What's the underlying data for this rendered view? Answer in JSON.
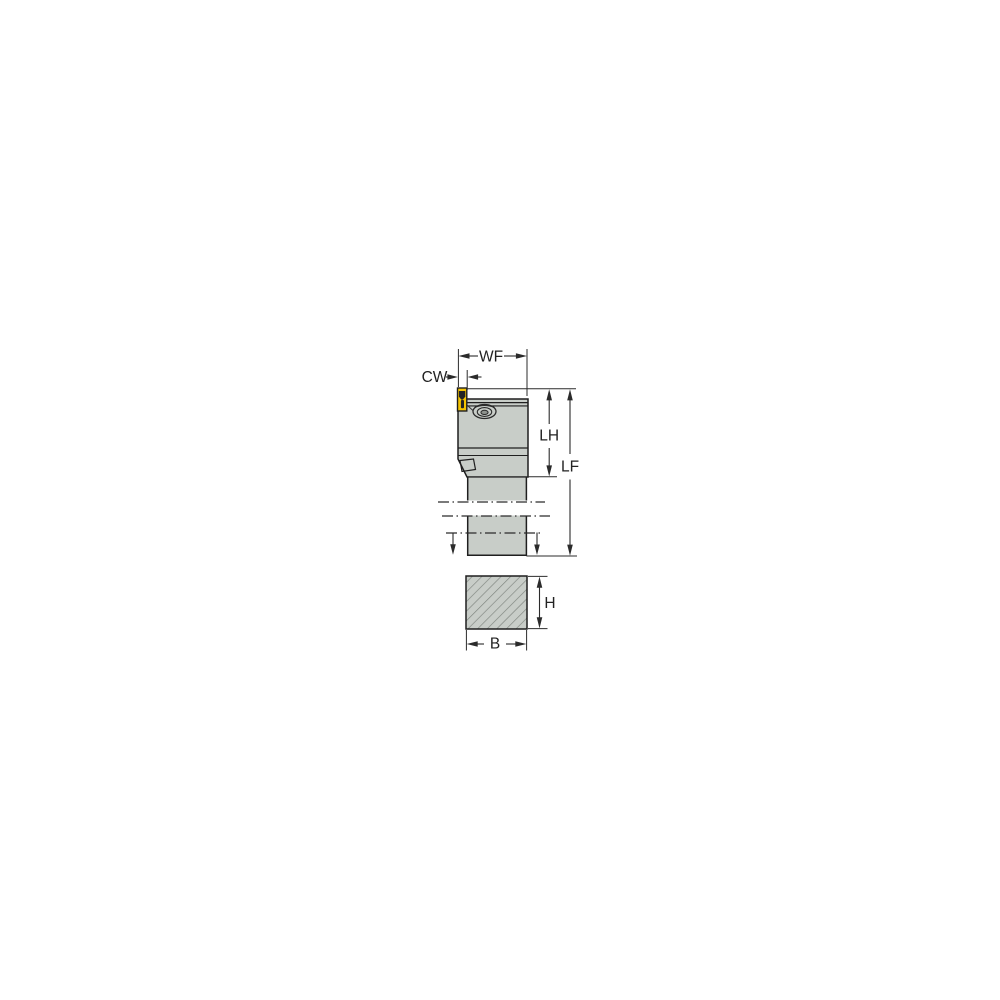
{
  "drawing": {
    "name": "Tool holder technical line drawing with shank cross-section",
    "views": {
      "side_view_label": "tool-holder-side-view",
      "cross_section_label": "shank-cross-section"
    },
    "dimensions": {
      "wf": {
        "label": "WF"
      },
      "cw": {
        "label": "CW"
      },
      "lh": {
        "label": "LH"
      },
      "lf": {
        "label": "LF"
      },
      "h": {
        "label": "H"
      },
      "b": {
        "label": "B"
      }
    },
    "colors": {
      "background": "#ffffff",
      "body_fill": "#c8cdc8",
      "outline": "#1f1f1f",
      "dimension_line": "#2b2b2b",
      "insert_fill": "#f5c400",
      "insert_detail": "#242424",
      "hatch_line": "#7e847e",
      "screw_center_fill": "#8e938e"
    }
  }
}
